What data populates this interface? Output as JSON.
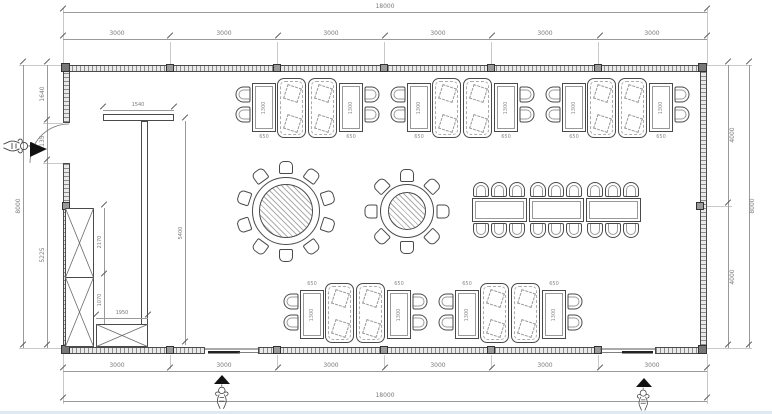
{
  "dims": {
    "top": {
      "total": "18000",
      "segments": [
        "3000",
        "3000",
        "3000",
        "3000",
        "3000",
        "3000"
      ]
    },
    "bottom": {
      "total": "18000",
      "segments": [
        "3000",
        "3000",
        "3000",
        "3000",
        "3000",
        "3000"
      ]
    },
    "left": {
      "total": "8000",
      "segments": [
        "1640",
        "1135",
        "5225"
      ]
    },
    "right": {
      "total": "8000",
      "segments": [
        "4000",
        "4000"
      ]
    },
    "interior": {
      "partition_length": "1540",
      "partition_run": "5400",
      "cabinet_upper_height": "2170",
      "cabinet_lower_height": "1070",
      "counter_length": "1950",
      "booth_table_width": "650",
      "booth_table_length": "1300"
    }
  },
  "colors": {
    "line": "#4a4a4a",
    "dim_text": "#7a7a7a",
    "wall_fill": "#e9e9e9",
    "marker_black": "#111111"
  }
}
